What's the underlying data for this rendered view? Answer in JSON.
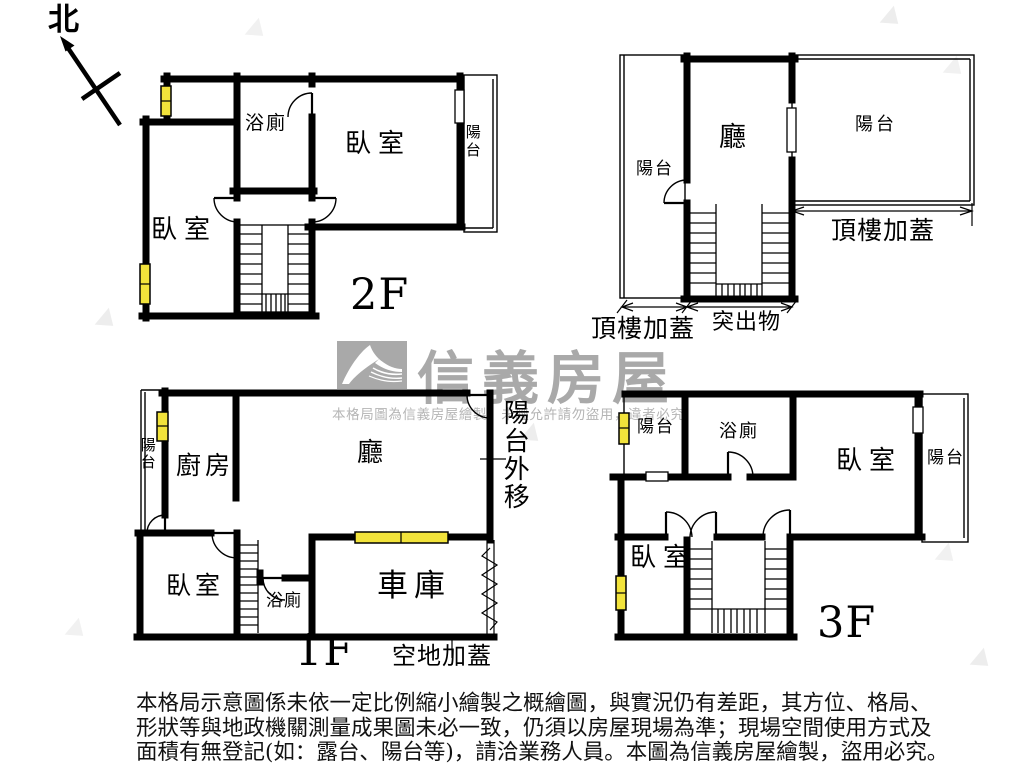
{
  "compass": {
    "north": "北"
  },
  "brand": {
    "name": "信義房屋",
    "watermark": "本格局圖為信義房屋繪製，未經允許請勿盜用，違者必究"
  },
  "floor2": {
    "label": "2F",
    "bath": "浴廁",
    "bedroom_main": "臥室",
    "bedroom_left": "臥室",
    "balcony": "陽台"
  },
  "roof": {
    "hall": "廳",
    "balcony_left": "陽台",
    "balcony_right": "陽台",
    "rooftop_addition_left": "頂樓加蓋",
    "rooftop_addition_right": "頂樓加蓋",
    "protrusion": "突出物"
  },
  "floor1": {
    "label": "1F",
    "balcony": "陽台",
    "kitchen": "廚房",
    "hall": "廳",
    "balcony_shift": "陽台外移",
    "bedroom": "臥室",
    "bath": "浴廁",
    "garage": "車庫",
    "ground_addition": "空地加蓋"
  },
  "floor3": {
    "label": "3F",
    "balcony_left": "陽台",
    "bath": "浴廁",
    "bedroom_main": "臥室",
    "balcony_right": "陽台",
    "bedroom_left": "臥室"
  },
  "disclaimer": {
    "line1": "本格局示意圖係未依一定比例縮小繪製之概繪圖，與實況仍有差距，其方位、格局、",
    "line2": "形狀等與地政機關測量成果圖未必一致，仍須以房屋現場為準；現場空間使用方式及",
    "line3": "面積有無登記(如：露台、陽台等)，請洽業務人員。本圖為信義房屋繪製，盜用必究。"
  },
  "colors": {
    "wall": "#000000",
    "window_fill": "#f2e33b",
    "logo_gray": "#a9a9a9",
    "watermark_gray": "#b5b5b5"
  }
}
